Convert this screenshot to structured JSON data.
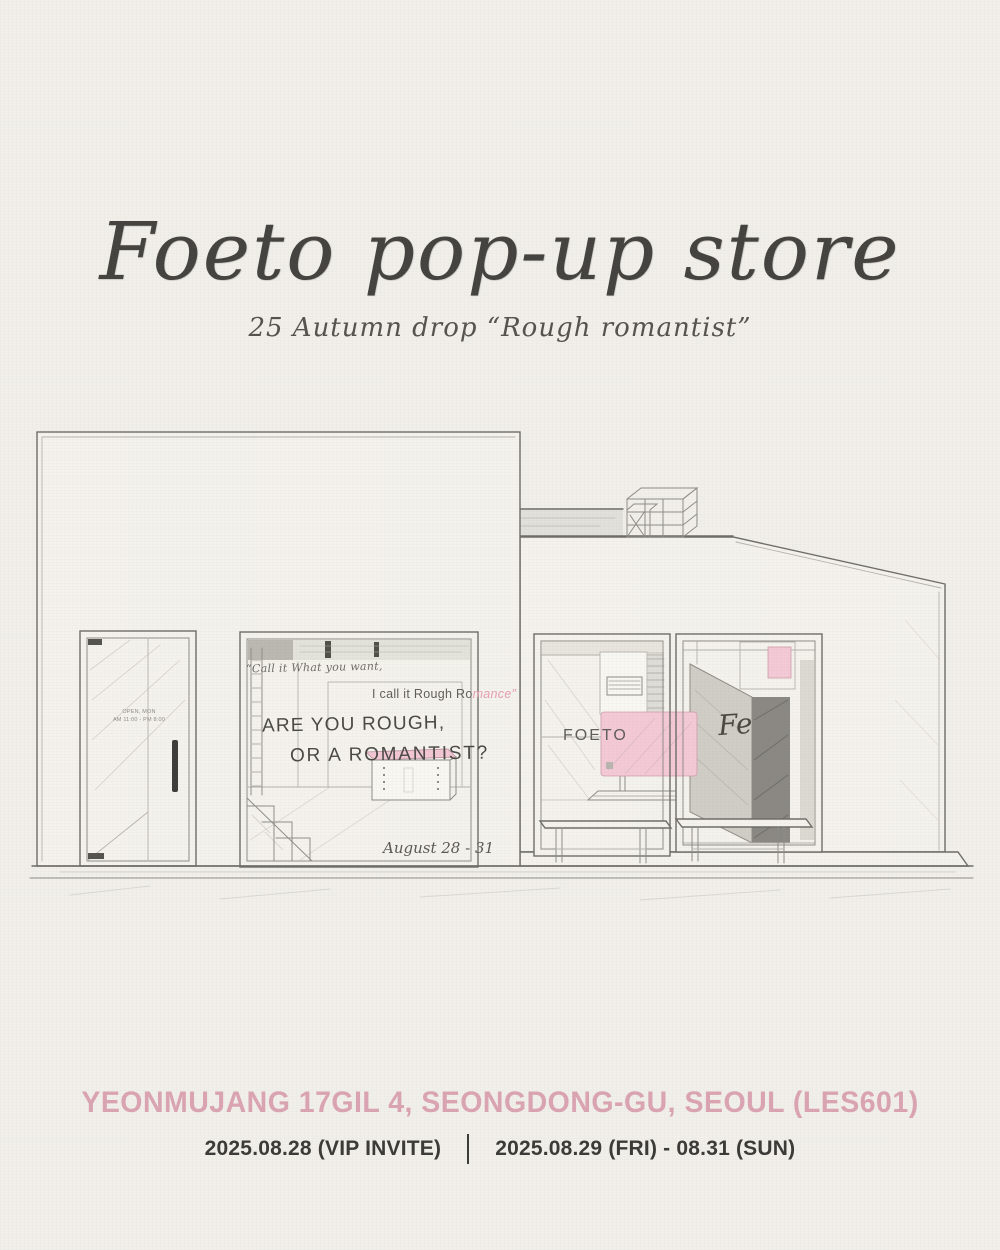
{
  "poster": {
    "title": "Foeto pop-up store",
    "subtitle": "25 Autumn drop “Rough romantist”",
    "address": "YEONMUJANG 17GIL 4, SEONGDONG-GU, SEOUL (LES601)",
    "dates": {
      "vip": "2025.08.28 (VIP INVITE)",
      "public": "2025.08.29 (FRI) - 08.31 (SUN)"
    }
  },
  "illustration": {
    "door_sign_line1": "OPEN, MON",
    "door_sign_line2": "AM 11:00 - PM 8:00",
    "window_quote_line1": "“Call it What you want,",
    "window_quote_line2_gray": "I call it Rough Ro",
    "window_quote_line2_pink": "mance”",
    "window_headline_line1": "ARE YOU ROUGH,",
    "window_headline_line2": "OR A ROMANTIST?",
    "window_date_note": "August 28 - 31",
    "storefront_sign": "FOETO",
    "monogram": "Fe"
  },
  "colors": {
    "background": "#f1efe9",
    "pencil_gray": "#6f6d68",
    "pink_panel": "#f4c9d6",
    "pink_text": "#dba4b3",
    "ink": "#3f3e3b"
  }
}
